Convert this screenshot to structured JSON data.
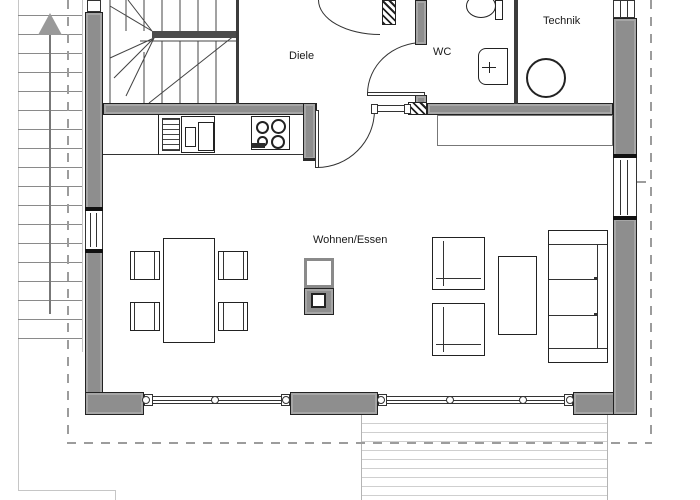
{
  "plan": {
    "rooms": {
      "diele": "Diele",
      "wc": "WC",
      "technik": "Technik",
      "wohnen_essen": "Wohnen/Essen"
    }
  },
  "colors": {
    "wall": "#8e8e8e",
    "wall-edge": "#222222",
    "ink": "#2b2b2b",
    "light": "#c6c6c6",
    "dash": "#9c9c9c",
    "deck": "#cfcfcf",
    "arrow": "#999999"
  }
}
